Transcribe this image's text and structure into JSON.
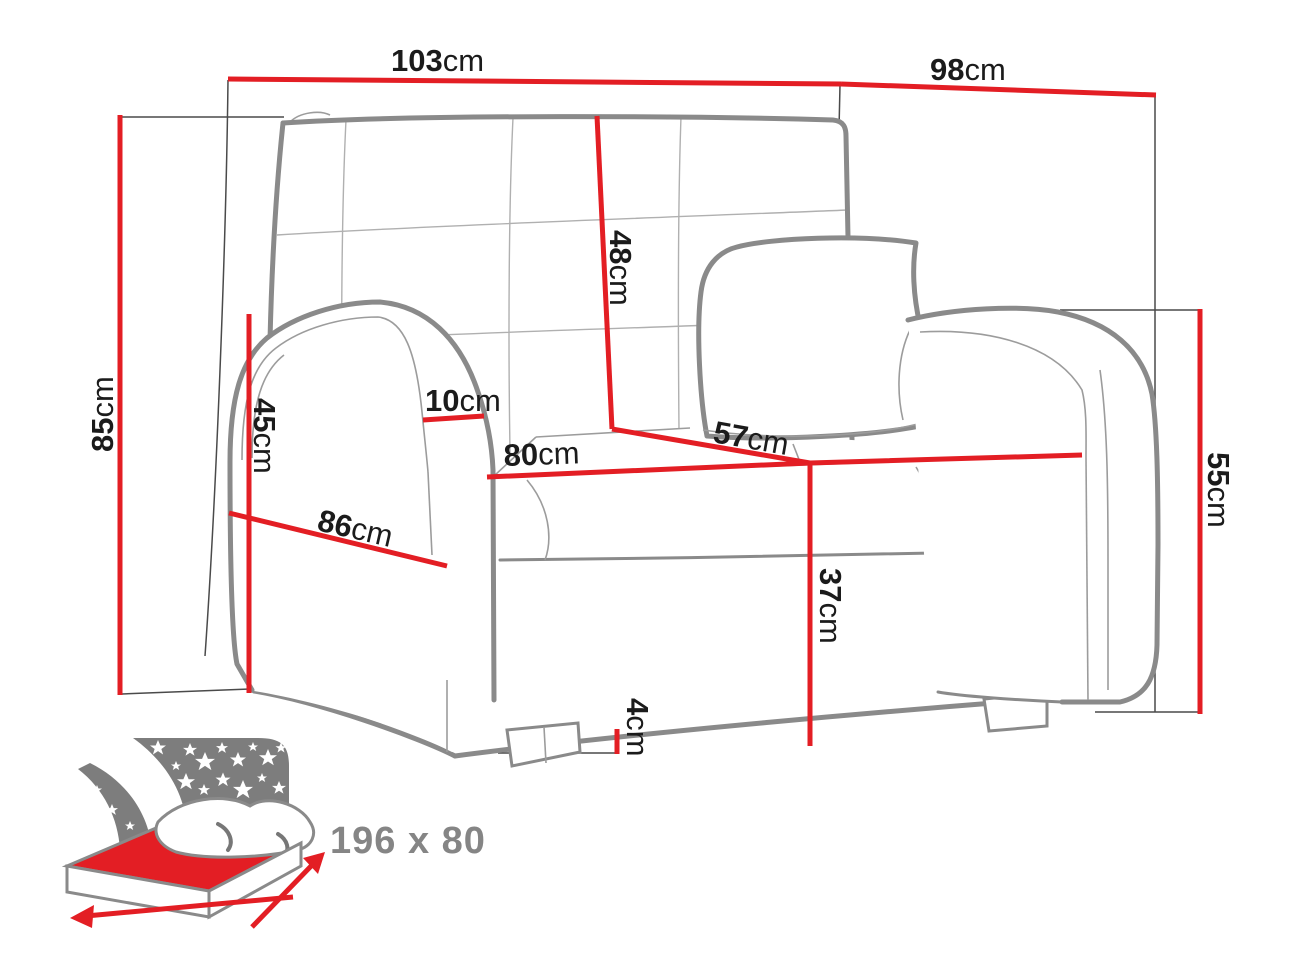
{
  "dimensions": {
    "total_width": {
      "num": "103",
      "unit": "cm"
    },
    "total_depth": {
      "num": "98",
      "unit": "cm"
    },
    "total_height": {
      "num": "85",
      "unit": "cm"
    },
    "backrest_height": {
      "num": "48",
      "unit": "cm"
    },
    "armrest_front_height": {
      "num": "45",
      "unit": "cm"
    },
    "armrest_width": {
      "num": "10",
      "unit": "cm"
    },
    "seat_width": {
      "num": "80",
      "unit": "cm"
    },
    "seat_depth": {
      "num": "57",
      "unit": "cm"
    },
    "side_depth": {
      "num": "86",
      "unit": "cm"
    },
    "armrest_right_height": {
      "num": "55",
      "unit": "cm"
    },
    "seat_height": {
      "num": "37",
      "unit": "cm"
    },
    "leg_height": {
      "num": "4",
      "unit": "cm"
    }
  },
  "sleeping_area": {
    "label": "196 x 80"
  },
  "colors": {
    "dimension_red": "#e31e24",
    "outline_gray": "#8a8a8a",
    "seam_gray": "#b0b0b0",
    "projection_dark": "#4a4a4a",
    "text_dark": "#1b1b1b",
    "icon_gray": "#7d7d7d",
    "sleeping_label_gray": "#858585",
    "background": "#ffffff"
  }
}
